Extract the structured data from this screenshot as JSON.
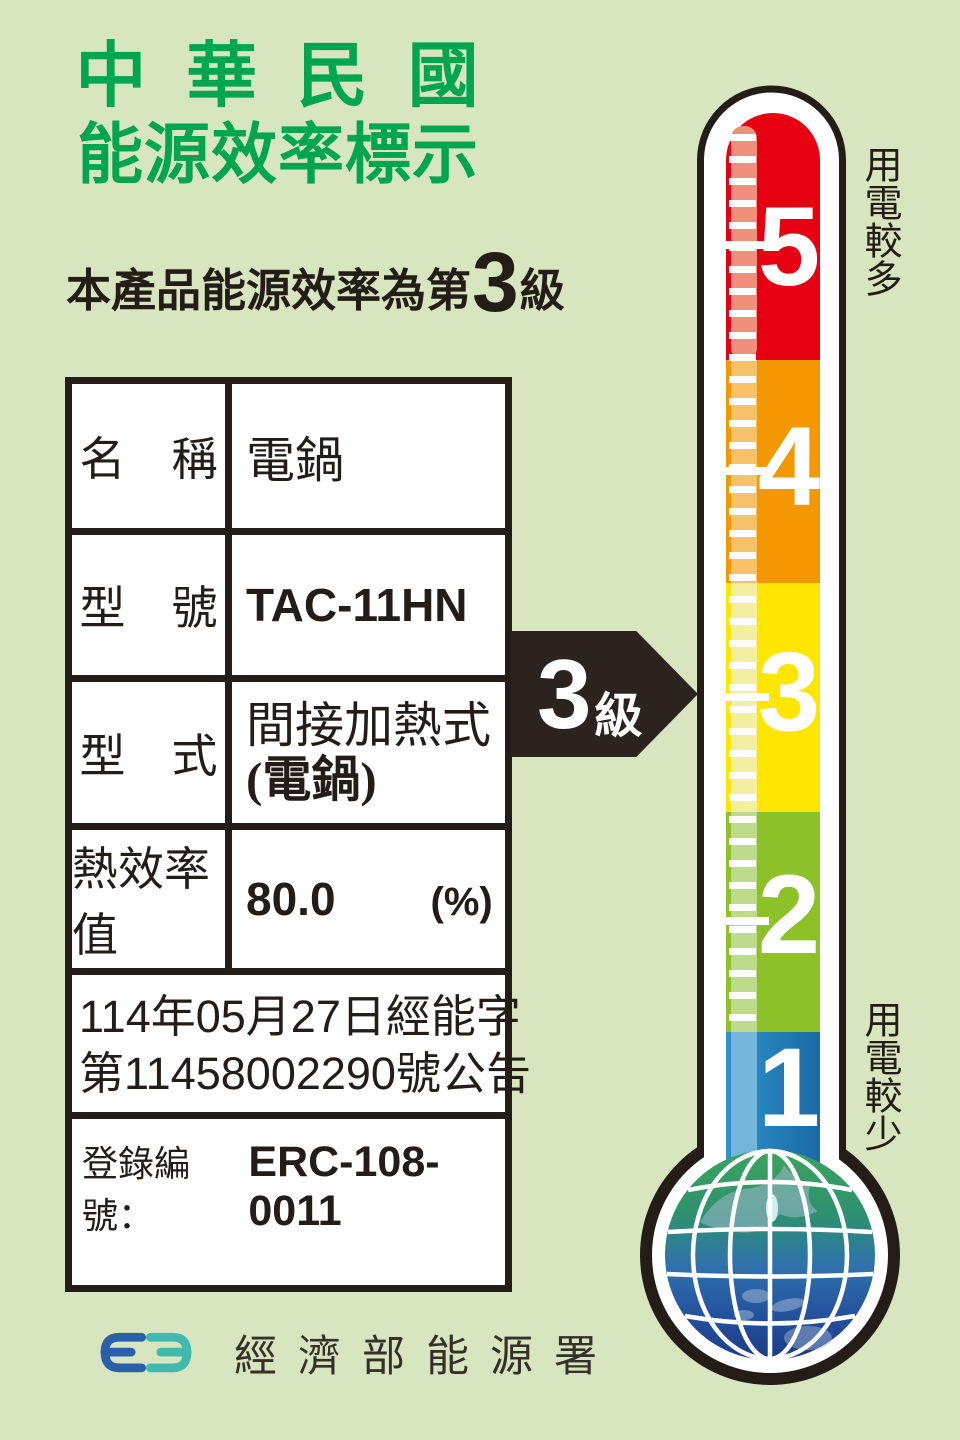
{
  "header": {
    "title_line1": "中 華 民 國",
    "title_line2": "能源效率標示",
    "subtitle_prefix": "本產品能源效率為第",
    "subtitle_grade": "3",
    "subtitle_suffix": "級"
  },
  "spec_table": {
    "rows": [
      {
        "label": "名　稱",
        "value": "電鍋"
      },
      {
        "label": "型　號",
        "value": "TAC-11HN"
      },
      {
        "label": "型　式",
        "value_line1": "間接加熱式",
        "value_line2": "(電鍋)"
      },
      {
        "label": "熱效率值",
        "value": "80.0",
        "unit": "(%)"
      }
    ],
    "announcement_line1": "114年05月27日經能字",
    "announcement_line2": "第11458002290號公告",
    "registration_label": "登錄編號：",
    "registration_value": "ERC-108-0011"
  },
  "grade_arrow": {
    "number": "3",
    "suffix": "級"
  },
  "thermometer": {
    "label_more": "用電較多",
    "label_less": "用電較少",
    "levels": [
      {
        "grade": "5",
        "color": "#e60012",
        "tint": "#ef8f7c"
      },
      {
        "grade": "4",
        "color": "#f39800",
        "tint": "#f6c169"
      },
      {
        "grade": "3",
        "color": "#ffe600",
        "tint": "#f2efa0"
      },
      {
        "grade": "2",
        "color": "#8cc127",
        "tint": "#bedb8b"
      },
      {
        "grade": "1",
        "color": "#2387c3",
        "tint": "#74b6da"
      }
    ]
  },
  "footer": {
    "agency": "經濟部能源署",
    "logo": "energy-administration-logo"
  },
  "colors": {
    "background": "#d8e6bf",
    "title_green": "#00a550",
    "ink": "#231c17",
    "arrow_black": "#2a231e"
  }
}
